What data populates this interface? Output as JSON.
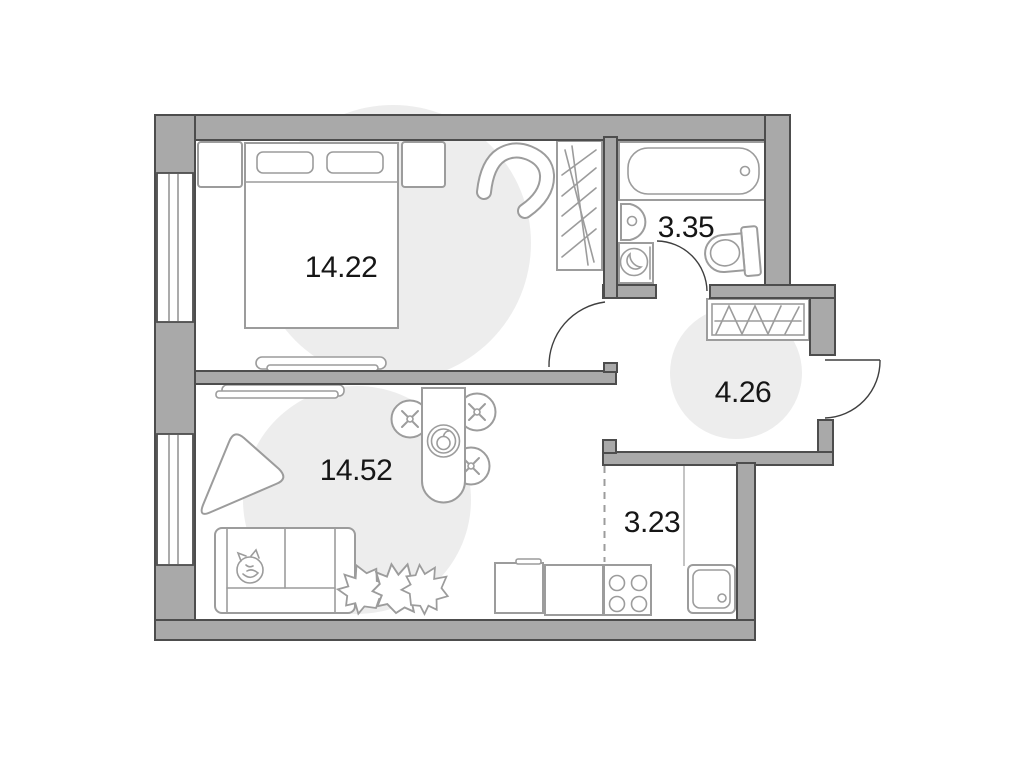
{
  "title": "One-bedroom apartment floor plan",
  "colors": {
    "wall_fill": "#a9a9a9",
    "wall_stroke": "#4d4d4d",
    "furniture_stroke": "#9c9c9c",
    "zone_fill": "#ededed",
    "door_stroke": "#3f3f3f",
    "text_color": "#161616"
  },
  "rooms": {
    "bedroom": {
      "area": "14.22",
      "fixtures": [
        "bed",
        "pillows",
        "nightstand-left",
        "nightstand-right",
        "armchair",
        "wardrobe",
        "bench",
        "window"
      ]
    },
    "bathroom": {
      "area": "3.35",
      "fixtures": [
        "bathtub",
        "sink",
        "washing-machine",
        "toilet",
        "door"
      ]
    },
    "hallway": {
      "area": "4.26",
      "fixtures": [
        "wardrobe",
        "entry-door"
      ]
    },
    "living_room": {
      "area": "14.52",
      "fixtures": [
        "sofa",
        "cat",
        "plant",
        "rug",
        "dining-table",
        "chairs",
        "tv-console",
        "window"
      ]
    },
    "kitchen": {
      "area": "3.23",
      "fixtures": [
        "dashed-zone-boundary",
        "dishwasher",
        "counter",
        "stove",
        "sink"
      ]
    }
  }
}
